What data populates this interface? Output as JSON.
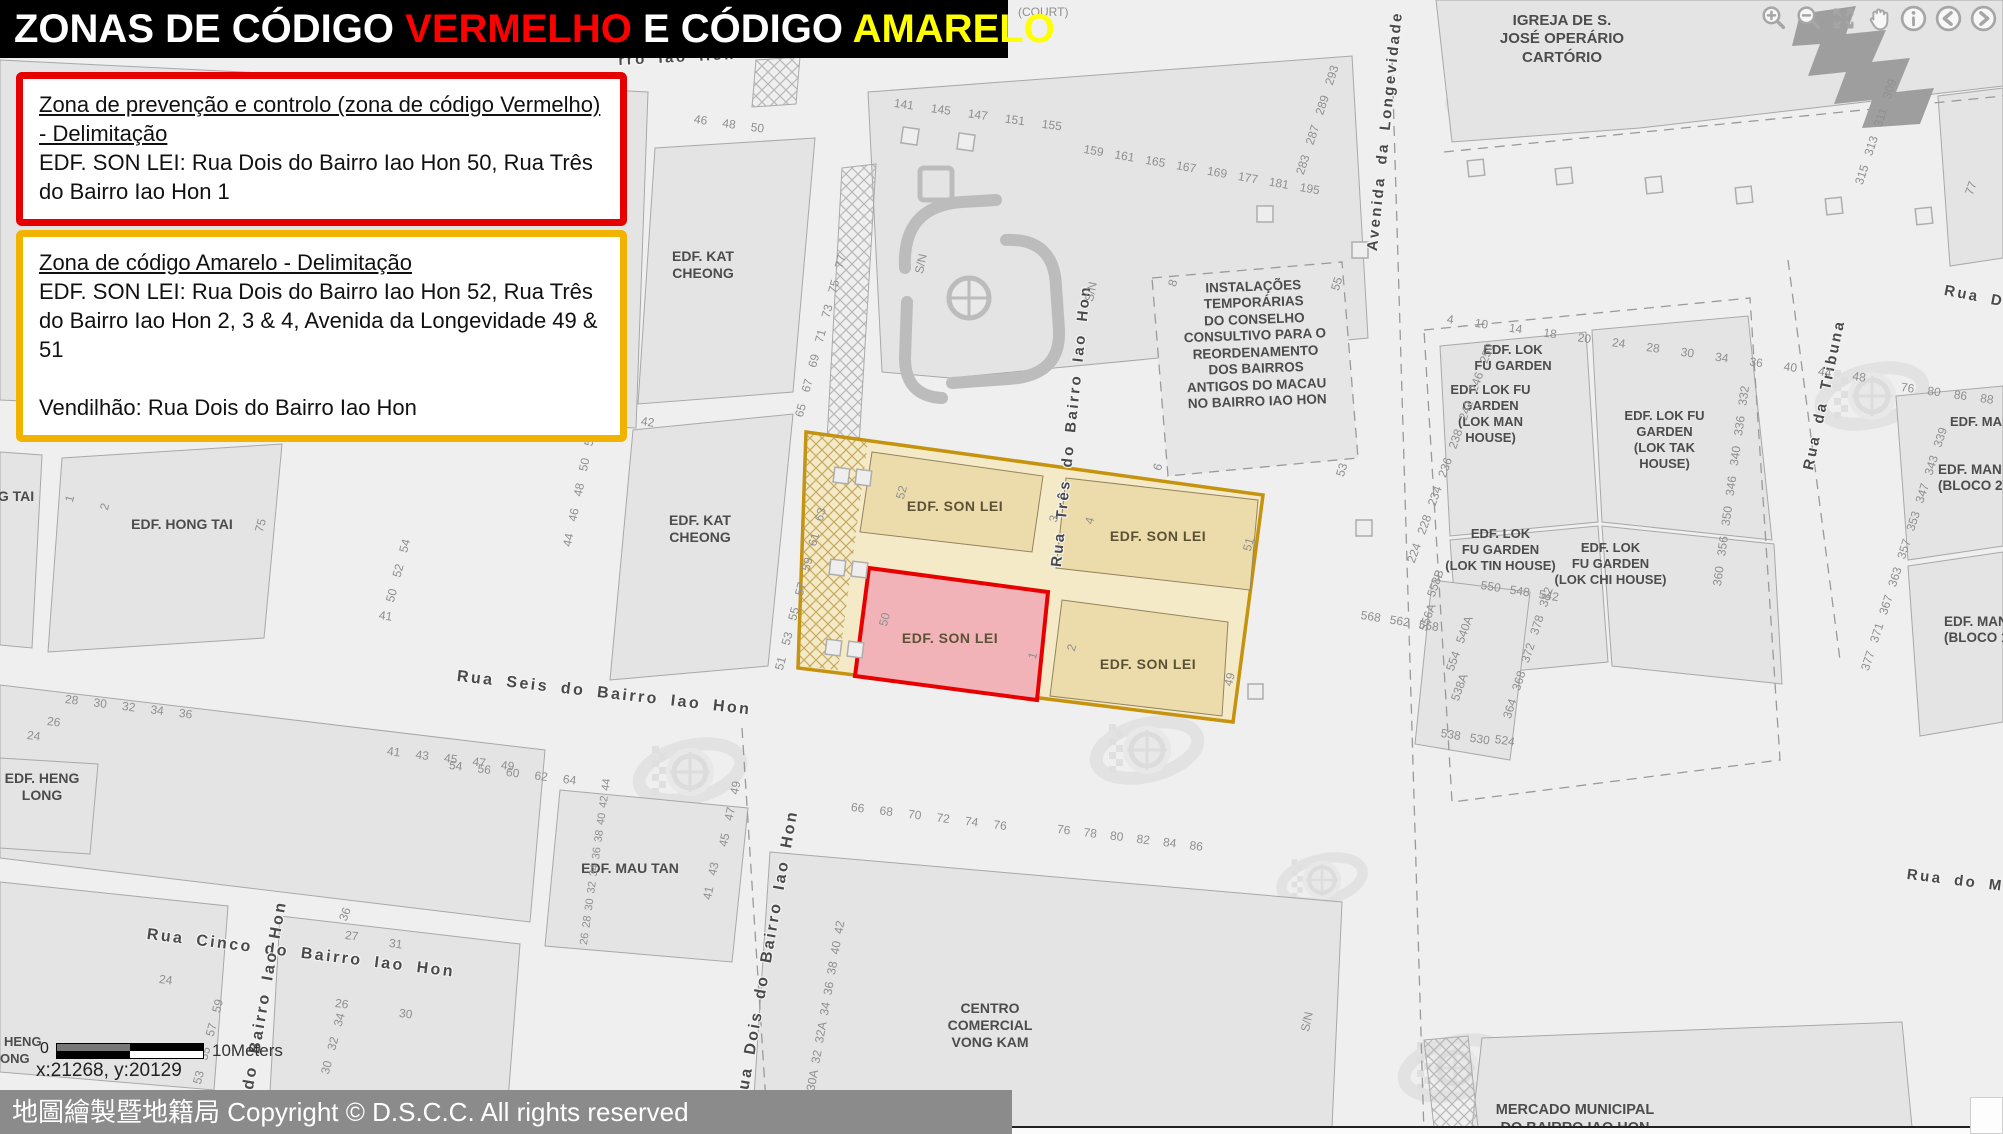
{
  "title": {
    "prefix": "ZONAS DE CÓDIGO ",
    "red": "VERMELHO",
    "middle": " E CÓDIGO ",
    "yellow": "AMARELO"
  },
  "red_box": {
    "heading": "Zona de prevenção e controlo (zona de código Vermelho) - Delimitação",
    "body": "EDF. SON LEI: Rua Dois do Bairro Iao Hon 50, Rua Três do Bairro Iao Hon 1"
  },
  "yellow_box": {
    "heading": "Zona de código Amarelo - Delimitação",
    "body": "EDF. SON LEI: Rua Dois do Bairro Iao Hon 52, Rua Três do Bairro Iao Hon 2, 3 & 4, Avenida da Longevidade 49 & 51",
    "vendor": "Vendilhão: Rua Dois do Bairro Iao Hon"
  },
  "toolbar": {
    "icons": [
      {
        "name": "zoom-in"
      },
      {
        "name": "zoom-out"
      },
      {
        "name": "zoom-full-extent"
      },
      {
        "name": "pan"
      },
      {
        "name": "identify-info"
      },
      {
        "name": "previous-extent"
      },
      {
        "name": "next-extent"
      }
    ]
  },
  "statusbar": {
    "copyright": "地圖繪製暨地籍局 Copyright © D.S.C.C. All rights reserved"
  },
  "scalebar": {
    "zero": "0",
    "label": "10Meters"
  },
  "coordinates": "x:21268, y:20129",
  "colors": {
    "title_red": "#ff0000",
    "title_yellow": "#ffff00",
    "red_box_border": "#e60000",
    "yellow_box_border": "#f2b200",
    "red_zone_border": "#e80000",
    "red_zone_fill": "#f1b3b8",
    "yellow_zone_border": "#c28e00",
    "yellow_zone_fill": "#f5e9c6",
    "statusbar_bg": "#8b8b8b"
  },
  "map": {
    "labels": {
      "igreja": "IGREJA DE S.\nJOSÉ OPERÁRIO\nCARTÓRIO",
      "instalacoes": "INSTALAÇÕES\nTEMPORÁRIAS\nDO CONSELHO\nCONSULTIVO PARA O\nREORDENAMENTO\nDOS BAIRROS\nANTIGOS DO MACAU\nNO BAIRRO IAO HON",
      "kat_cheong": "EDF. KAT\nCHEONG",
      "hong_tai": "EDF. HONG TAI",
      "g_tai": "G TAI",
      "heng_long": "EDF. HENG\nLONG",
      "mau_tan": "EDF. MAU TAN",
      "centro": "CENTRO\nCOMERCIAL\nVONG KAM",
      "mercado": "MERCADO MUNICIPAL\nDO BAIRRO IAO HON",
      "lok_fu": "EDF. LOK\nFU GARDEN",
      "lok_man": "EDF. LOK FU\nGARDEN\n(LOK MAN\nHOUSE)",
      "lok_tak": "EDF. LOK FU\nGARDEN\n(LOK TAK\nHOUSE)",
      "lok_tin": "EDF. LOK\nFU GARDEN\n(LOK TIN HOUSE)",
      "lok_chi": "EDF. LOK\nFU GARDEN\n(LOK CHI HOUSE)",
      "man_on_2": "EDF. MAN O\n(BLOCO 2)",
      "man_on_1": "EDF. MAN O\n(BLOCO 1)",
      "man_on_frag": "EDF. MAN",
      "son_lei": "EDF. SON LEI",
      "heng_frag": "HENG",
      "ong_frag": "ONG"
    },
    "streets": {
      "rua_seis": "Rua Seis do Bairro Iao Hon",
      "rua_cinco": "Rua Cinco do Bairro Iao Hon",
      "rua_dois": "Rua Dois do Bairro Iao Hon",
      "rua_tres": "Rua Três do Bairro Iao Hon",
      "avenida": "Avenida da Longevidade",
      "tribuna": "Rua da Tribuna",
      "do_bairro": "do Bairro Iao Hon",
      "rro_frag": "rro Iao Hon",
      "rua_do_mer": "Rua do Mer",
      "rua_din": "Rua Din"
    },
    "numbers": {
      "top_a": "141 145 147 151 155",
      "top_b": "159 161 165 167 169 177 181 195",
      "top_c": "283 287 289 293",
      "court": "(COURT)",
      "kat_north_top": "46 48 50",
      "kat_north_right": "65 67 69 71 73 75 77",
      "kat_south_top": "42",
      "kat_south_right": "51 53 55 57 59 61 63",
      "street_col_a": "44 46 48 50 52 54 56 58",
      "street_col_b": "50 52 54",
      "hong_41": "41",
      "hong_1": "1",
      "hong_2": "2",
      "hong_75": "75",
      "seis_row": "41 43 45 47 49",
      "seis_row_left": "28 30 32 34 36",
      "n26": "26",
      "n24": "24",
      "mau_col": "26 28 30 32 34 36 38 40 42 44",
      "mau_top": "54 56 60 62 64",
      "dois_col_a": "45 47 49",
      "dois_col_b": "30 30A 32 32A 34 36 38 40 42",
      "dois_41_43": "41 43",
      "inst_8": "8",
      "inst_55": "55",
      "inst_6": "6",
      "inst_53": "53",
      "zone_52": "52",
      "zone_3": "3",
      "zone_4": "4",
      "zone_51": "51",
      "zone_50": "50",
      "zone_1": "1",
      "zone_2": "2",
      "zone_49": "49",
      "sn": "S/N",
      "lok_left": "224 228 234 236 238 242 246 250",
      "lok_top": "4 10 14 18 20 24 28 30 34 36 40 44 48",
      "lok_right": "360 356 350 346 340 336 332",
      "lok_s1": "568 562 558",
      "lok_s2": "558B",
      "lok_s3": "556A",
      "lok_s4": "554 540A",
      "lok_s5": "538A",
      "lok_s6": "538 530",
      "lok_s7": "524",
      "lok_s8": "550 548 542",
      "lok_s9": "364 368 372 378 382",
      "man_left": "377 371 367 363 357 353 347 343 339",
      "man_top": "76 80 86 88",
      "church_col": "315 313 311 309",
      "n77": "77",
      "cinco_36": "36",
      "cinco_27": "27",
      "cinco_31": "31",
      "cinco_26": "26",
      "cinco_30": "30",
      "cinco_col_a": "30 32 34",
      "cinco_24": "24",
      "cinco_col_b": "53 55 57 59",
      "mid_row_a": "66 68 70 72 74 76",
      "mid_row_b": "76 78 80 82 84 86"
    }
  }
}
